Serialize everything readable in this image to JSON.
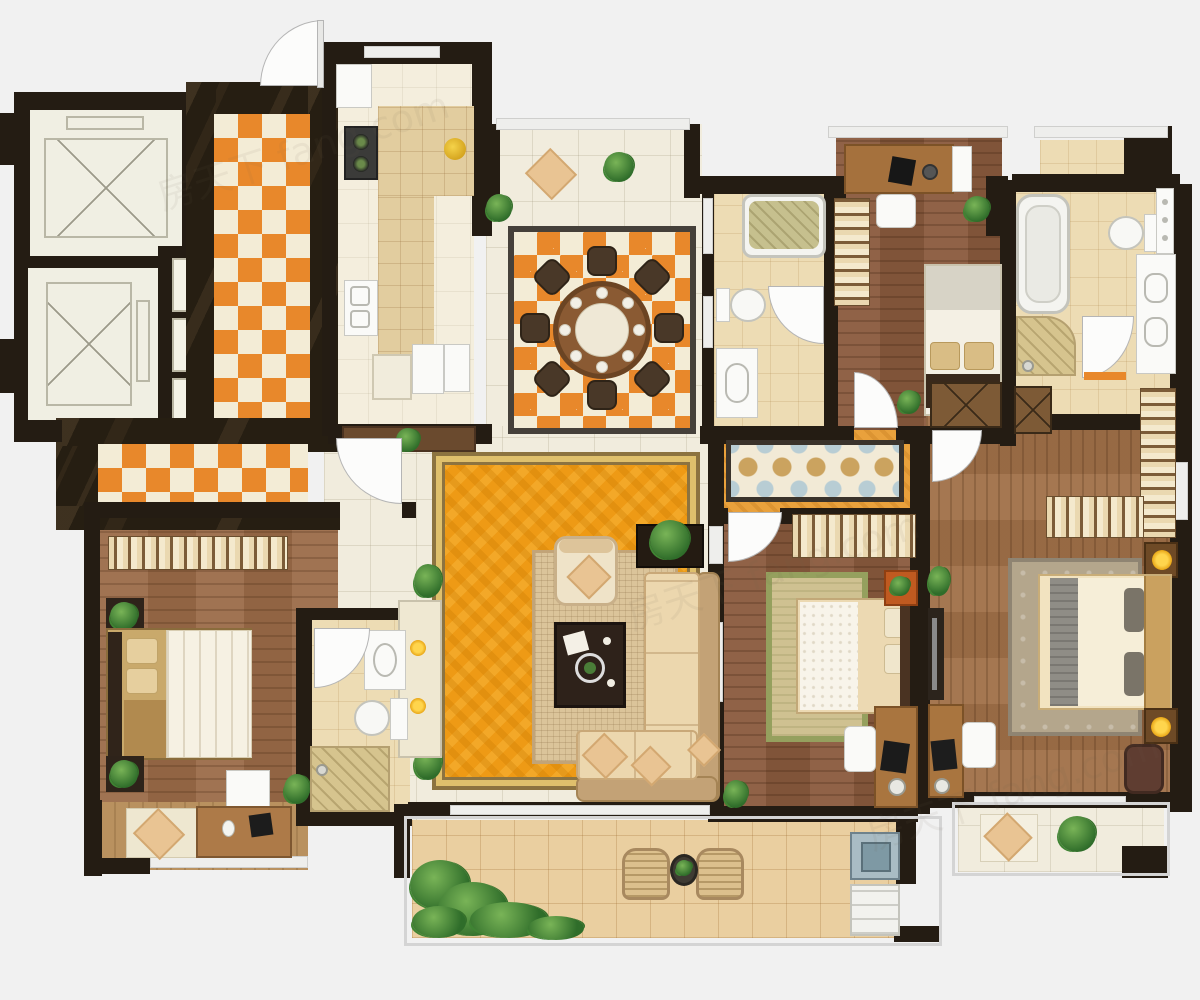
{
  "meta": {
    "type": "residential-floor-plan-top-down-render",
    "canvas": {
      "width": 1200,
      "height": 1000
    }
  },
  "watermark": {
    "text": "房天下 fang.com"
  },
  "palette": {
    "wall": "#241c13",
    "tileOrange": "#e8882b",
    "rug": "#ee9a15",
    "corridorOrange": "#e9a13c",
    "marble": "#f1ecdd",
    "bg": "#f1f1f1",
    "green": "#4c8a3c",
    "glow": "#f3c01c",
    "woodBedroom": "#9a6a47",
    "woodDark": "#8a5a3d",
    "woodMaster": "#a07048",
    "bathTile": "#eddcb4",
    "balconyTile": "#eacfa0",
    "sofa": "#ecd7ae",
    "sofaBack": "#c3a276"
  },
  "rooms": [
    {
      "name": "elevator-lobby",
      "floor": "dark-marble with orange diamond tile runner"
    },
    {
      "name": "elevator-shaft-1",
      "furniture": [
        "elevator-car-x-symbol"
      ]
    },
    {
      "name": "elevator-shaft-2",
      "furniture": [
        "elevator-car-x-symbol"
      ]
    },
    {
      "name": "stairwell",
      "furniture": [
        "stair-landings"
      ]
    },
    {
      "name": "entry-hallway",
      "floor": "orange-diamond-tile"
    },
    {
      "name": "kitchen",
      "furniture": [
        "fridge",
        "cooktop",
        "double-sink",
        "l-shaped-tiled-counter",
        "fruit-bowl",
        "appliances",
        "wood-bench",
        "plant"
      ]
    },
    {
      "name": "dining-room",
      "floor": "diamond-tile-inset",
      "furniture": [
        "round-wood-table",
        "eight-chairs",
        "eight-place-settings",
        "plant"
      ]
    },
    {
      "name": "north-bay-window",
      "furniture": [
        "lounge-cushion",
        "plant"
      ]
    },
    {
      "name": "living-room",
      "furniture": [
        "ornate-orange-rug",
        "inner-woven-rug",
        "armchair",
        "dark-coffee-table",
        "l-shaped-sectional-sofa",
        "throw-pillows",
        "tv-cabinet",
        "plants",
        "console-with-lamps"
      ]
    },
    {
      "name": "hallway",
      "floor": "orange-tile-with-mosaic-runner"
    },
    {
      "name": "bedroom-1",
      "furniture": [
        "double-bed",
        "wardrobe-strip",
        "nightstands",
        "plants",
        "white-desk"
      ]
    },
    {
      "name": "ensuite-bathroom-1",
      "furniture": [
        "vanity-sink",
        "toilet",
        "shower-area"
      ]
    },
    {
      "name": "bathroom-2",
      "furniture": [
        "bathtub",
        "toilet",
        "vanity-sink",
        "window"
      ]
    },
    {
      "name": "bedroom-2",
      "furniture": [
        "single-bed",
        "wardrobe-strip",
        "bay-desk",
        "monitor",
        "desk-chair",
        "plants"
      ]
    },
    {
      "name": "master-bathroom",
      "furniture": [
        "bathtub",
        "toilet",
        "double-vanity",
        "shower-mat",
        "window"
      ]
    },
    {
      "name": "bedroom-3",
      "furniture": [
        "double-bed",
        "green-border-rug",
        "wardrobe-strip",
        "orange-nightstand",
        "desk",
        "chair",
        "laptop",
        "plant"
      ]
    },
    {
      "name": "master-bedroom",
      "furniture": [
        "king-bed",
        "grey-runner",
        "area-rug",
        "wardrobes",
        "x-front-cabinets",
        "lamp-nightstands",
        "armchair",
        "desk",
        "laptop",
        "chair",
        "tv-console",
        "plant"
      ]
    },
    {
      "name": "balcony-left",
      "furniture": [
        "lounge-cushion",
        "wood-desk",
        "laptop",
        "mouse"
      ]
    },
    {
      "name": "balcony-center",
      "furniture": [
        "wicker-chair",
        "wicker-chair",
        "round-plant-table",
        "washing-machine",
        "dryer",
        "shrubs"
      ]
    },
    {
      "name": "balcony-right-bay",
      "furniture": [
        "lounge-cushion",
        "plant"
      ]
    }
  ]
}
